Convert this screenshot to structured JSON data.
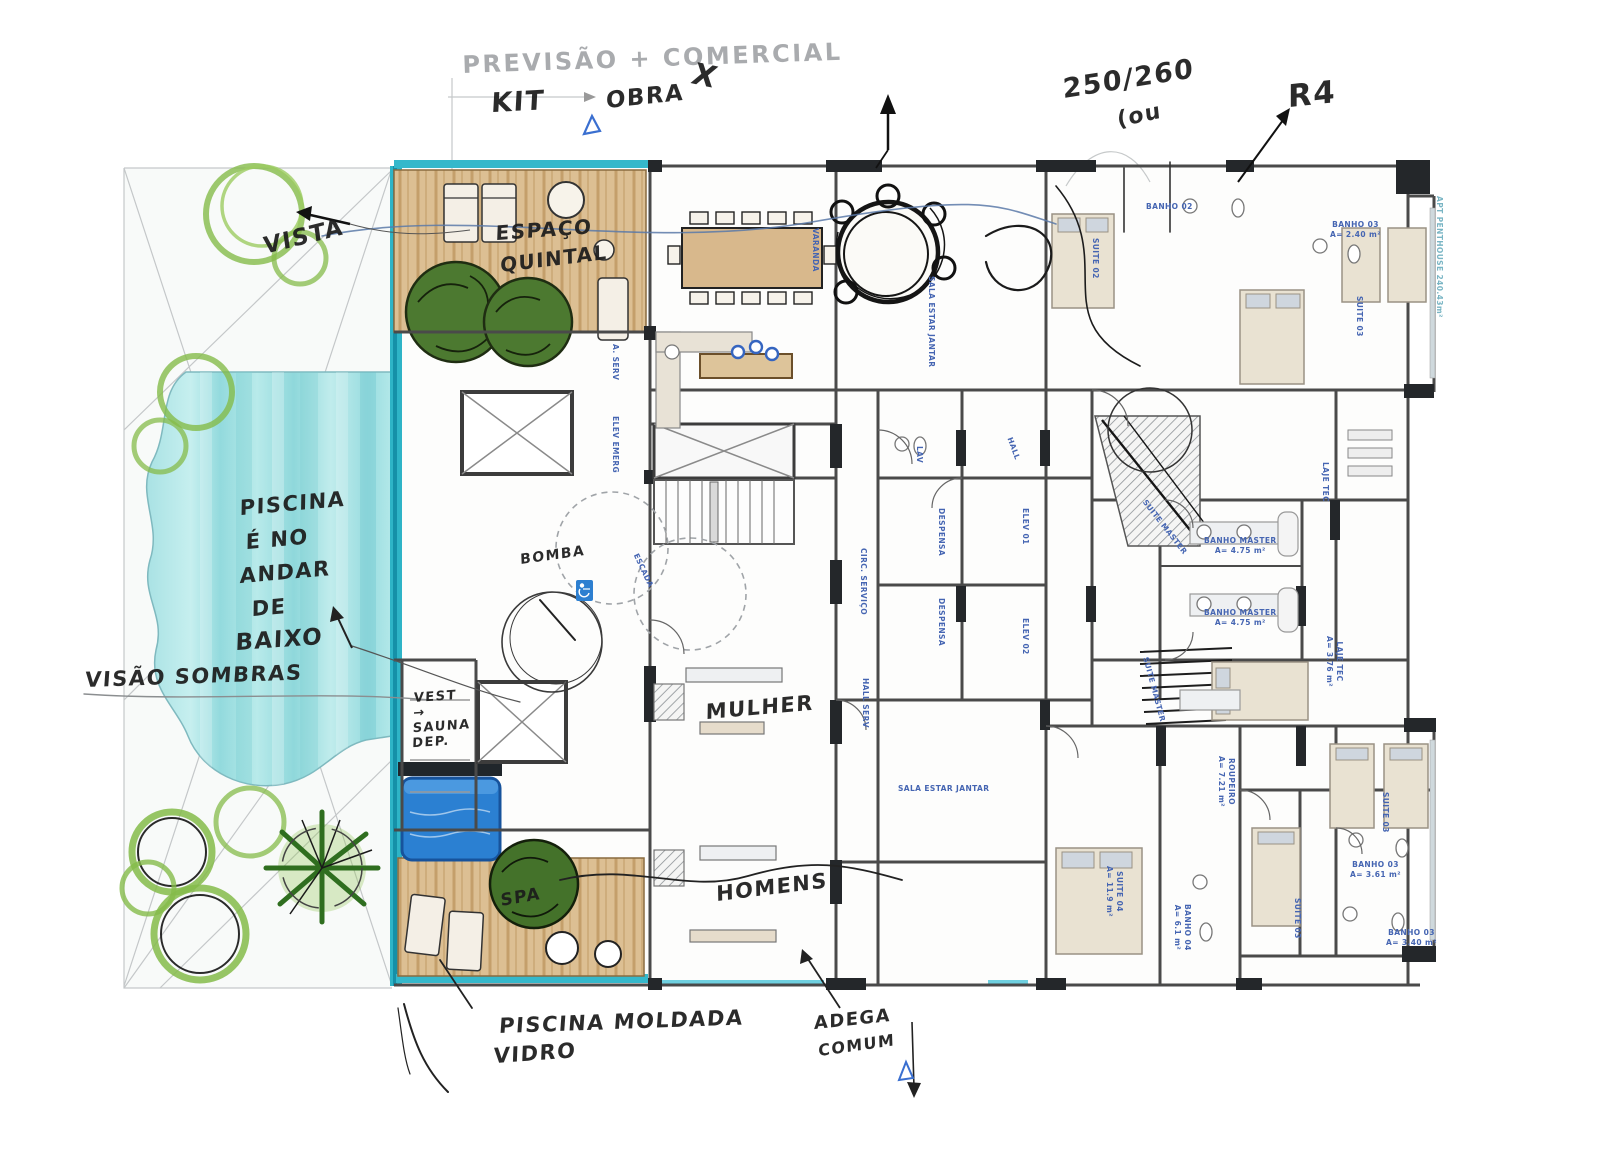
{
  "palette": {
    "paper": "#ffffff",
    "ink": "#1c1c1c",
    "pencil": "#94979b",
    "cad_blue": "#4565b2",
    "cad_cyan": "#79b5c4",
    "pool_teal": "#9fdfe2",
    "glass_strip_teal": "#2eb4c7",
    "spa_pool_blue": "#2b80d2",
    "deck_wood": "#dcbf93",
    "tree_marker_green": "#85bb4a",
    "tree_dark_green": "#4c7930"
  },
  "annotations": {
    "pencil": [
      {
        "n": "note-previsao-comercial",
        "t": "PREVISÃO + COMERCIAL",
        "x": 462,
        "y": 52,
        "s": 24,
        "r": -2
      }
    ],
    "ink": [
      {
        "n": "note-kit",
        "t": "KIT",
        "x": 492,
        "y": 88,
        "s": 27,
        "r": -3
      },
      {
        "n": "note-obra",
        "t": "OBRA",
        "x": 606,
        "y": 88,
        "s": 23,
        "r": -6
      },
      {
        "n": "note-x-mark",
        "t": "X",
        "x": 698,
        "y": 58,
        "s": 30,
        "r": 12
      },
      {
        "n": "note-250-260",
        "t": "250/260",
        "x": 1062,
        "y": 74,
        "s": 27,
        "r": -9
      },
      {
        "n": "note-ou",
        "t": "(ou",
        "x": 1116,
        "y": 108,
        "s": 22,
        "r": -12
      },
      {
        "n": "note-r4",
        "t": "R4",
        "x": 1288,
        "y": 80,
        "s": 31,
        "r": -6
      },
      {
        "n": "note-vista",
        "t": "VISTA",
        "x": 262,
        "y": 234,
        "s": 23,
        "r": -14
      },
      {
        "n": "note-espaco",
        "t": "ESPAÇO",
        "x": 496,
        "y": 222,
        "s": 20,
        "r": -4
      },
      {
        "n": "note-quintal",
        "t": "QUINTAL",
        "x": 500,
        "y": 254,
        "s": 20,
        "r": -7
      },
      {
        "n": "note-piscina-line1",
        "t": "PISCINA",
        "x": 240,
        "y": 496,
        "s": 21,
        "r": -5
      },
      {
        "n": "note-piscina-line2",
        "t": "É NO",
        "x": 246,
        "y": 530,
        "s": 21,
        "r": -5
      },
      {
        "n": "note-piscina-line3",
        "t": "ANDAR",
        "x": 240,
        "y": 564,
        "s": 21,
        "r": -5
      },
      {
        "n": "note-piscina-line4",
        "t": "DE",
        "x": 252,
        "y": 597,
        "s": 21,
        "r": -5
      },
      {
        "n": "note-piscina-line5",
        "t": "BAIXO",
        "x": 236,
        "y": 630,
        "s": 23,
        "r": -4
      },
      {
        "n": "note-visao-sombras",
        "t": "VISÃO SOMBRAS",
        "x": 86,
        "y": 668,
        "s": 21,
        "r": -2
      },
      {
        "n": "note-vest-sauna-dep",
        "t": "VEST\n→\nSAUNA\nDEP.",
        "x": 414,
        "y": 692,
        "s": 13,
        "r": -4
      },
      {
        "n": "note-bomba",
        "t": "BOMBA",
        "x": 520,
        "y": 552,
        "s": 14,
        "r": -8
      },
      {
        "n": "note-mulher",
        "t": "MULHER",
        "x": 706,
        "y": 700,
        "s": 21,
        "r": -5
      },
      {
        "n": "note-homens",
        "t": "HOMENS",
        "x": 716,
        "y": 882,
        "s": 21,
        "r": -7
      },
      {
        "n": "note-spa",
        "t": "SPA",
        "x": 500,
        "y": 892,
        "s": 17,
        "r": -10
      },
      {
        "n": "note-piscina-moldada",
        "t": "PISCINA MOLDADA",
        "x": 500,
        "y": 1014,
        "s": 21,
        "r": -2
      },
      {
        "n": "note-vidro",
        "t": "VIDRO",
        "x": 494,
        "y": 1044,
        "s": 21,
        "r": -4
      },
      {
        "n": "note-adega",
        "t": "ADEGA",
        "x": 814,
        "y": 1014,
        "s": 18,
        "r": -6
      },
      {
        "n": "note-comum",
        "t": "COMUM",
        "x": 818,
        "y": 1042,
        "s": 16,
        "r": -8
      }
    ],
    "cad": [
      {
        "n": "room-varanda",
        "t": "VARANDA",
        "x": 820,
        "y": 228,
        "r": 90
      },
      {
        "n": "room-sala-estar-jantar",
        "t": "SALA ESTAR JANTAR",
        "x": 936,
        "y": 276,
        "r": 90
      },
      {
        "n": "room-a-serv",
        "t": "A. SERV",
        "x": 620,
        "y": 344,
        "r": 90
      },
      {
        "n": "room-elev-emerg",
        "t": "ELEV EMERG",
        "x": 620,
        "y": 416,
        "r": 90
      },
      {
        "n": "room-escada",
        "t": "ESCADA",
        "x": 640,
        "y": 552,
        "r": 65
      },
      {
        "n": "room-lav",
        "t": "LAV",
        "x": 924,
        "y": 446,
        "r": 90
      },
      {
        "n": "room-hall",
        "t": "HALL",
        "x": 1014,
        "y": 436,
        "r": 70
      },
      {
        "n": "room-despensa-1",
        "t": "DESPENSA",
        "x": 946,
        "y": 508,
        "r": 90
      },
      {
        "n": "room-despensa-2",
        "t": "DESPENSA",
        "x": 946,
        "y": 598,
        "r": 90
      },
      {
        "n": "room-circ-servico",
        "t": "CIRC. SERVIÇO",
        "x": 868,
        "y": 548,
        "r": 90
      },
      {
        "n": "room-elev-01",
        "t": "ELEV 01",
        "x": 1030,
        "y": 508,
        "r": 90
      },
      {
        "n": "room-elev-02",
        "t": "ELEV 02",
        "x": 1030,
        "y": 618,
        "r": 90
      },
      {
        "n": "room-hall-serv",
        "t": "HALL SERV",
        "x": 870,
        "y": 678,
        "r": 90
      },
      {
        "n": "room-banho-master-1",
        "t": "BANHO MASTER\nA= 4.75 m²",
        "x": 1204,
        "y": 536,
        "r": 0
      },
      {
        "n": "room-banho-master-2",
        "t": "BANHO MASTER\nA= 4.75 m²",
        "x": 1204,
        "y": 608,
        "r": 0
      },
      {
        "n": "room-suite-master-1",
        "t": "SUITE MASTER",
        "x": 1148,
        "y": 498,
        "r": 52
      },
      {
        "n": "room-suite-master-2",
        "t": "SUITE MASTER",
        "x": 1150,
        "y": 656,
        "r": 75
      },
      {
        "n": "room-laje-tec-1",
        "t": "LAJE TEC",
        "x": 1330,
        "y": 462,
        "r": 90
      },
      {
        "n": "room-laje-tec-2",
        "t": "LAJE TEC\nA= 3.76 m²",
        "x": 1344,
        "y": 636,
        "r": 90
      },
      {
        "n": "room-roupeiro",
        "t": "ROUPEIRO\nA= 7.21 m²",
        "x": 1236,
        "y": 756,
        "r": 90
      },
      {
        "n": "room-suite-03-a",
        "t": "SUITE 03",
        "x": 1390,
        "y": 792,
        "r": 90
      },
      {
        "n": "room-suite-03-b",
        "t": "SUITE 03",
        "x": 1302,
        "y": 898,
        "r": 90
      },
      {
        "n": "room-banho-03-a",
        "t": "BANHO 03\nA= 3.61 m²",
        "x": 1350,
        "y": 860,
        "r": 0
      },
      {
        "n": "room-banho-03-b",
        "t": "BANHO 03\nA= 3.40 m²",
        "x": 1386,
        "y": 928,
        "r": 0
      },
      {
        "n": "room-suite-04",
        "t": "SUITE 04\nA= 11.9 m²",
        "x": 1124,
        "y": 866,
        "r": 90
      },
      {
        "n": "room-banho-04",
        "t": "BANHO 04\nA= 6.1 m²",
        "x": 1192,
        "y": 904,
        "r": 90
      },
      {
        "n": "room-sala-estar-jantar-2",
        "t": "SALA ESTAR JANTAR",
        "x": 898,
        "y": 784,
        "r": 0
      },
      {
        "n": "room-suite-02",
        "t": "SUITE 02",
        "x": 1100,
        "y": 238,
        "r": 90
      },
      {
        "n": "room-banho-02",
        "t": "BANHO 02",
        "x": 1146,
        "y": 202,
        "r": 0
      },
      {
        "n": "room-banho-03-top",
        "t": "BANHO 03\nA= 2.40 m²",
        "x": 1330,
        "y": 220,
        "r": 0
      },
      {
        "n": "room-suite-03-top",
        "t": "SUITE 03",
        "x": 1364,
        "y": 296,
        "r": 90
      },
      {
        "n": "apt-penthouse",
        "t": "APT PENTHOUSE 240.43m²",
        "x": 1444,
        "y": 196,
        "r": 90,
        "c": "cyan"
      }
    ]
  }
}
